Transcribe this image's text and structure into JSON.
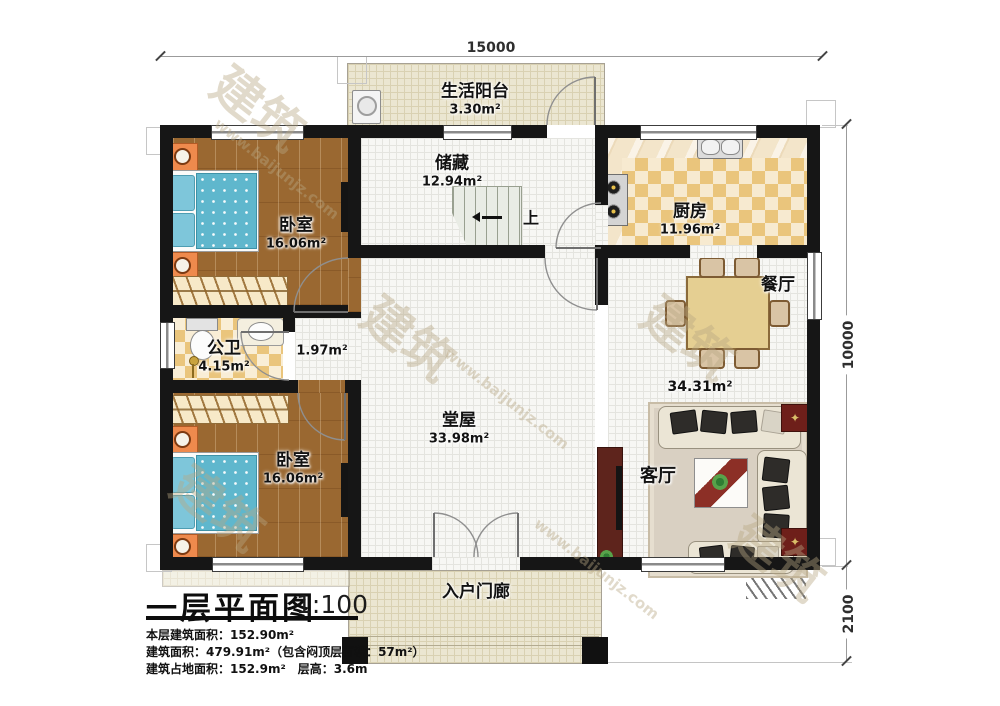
{
  "plan": {
    "dimensions": {
      "width_top": "15000",
      "height_right": "10000",
      "porch_depth": "2100"
    },
    "rooms": {
      "balcony": {
        "label": "生活阳台",
        "area": "3.30m²"
      },
      "storage": {
        "label": "储藏",
        "area": "12.94m²"
      },
      "kitchen": {
        "label": "厨房",
        "area": "11.96m²"
      },
      "bedroom_top": {
        "label": "卧室",
        "area": "16.06m²"
      },
      "bathroom": {
        "label": "公卫",
        "area": "4.15m²"
      },
      "hallway": {
        "area": "1.97m²"
      },
      "bedroom_bottom": {
        "label": "卧室",
        "area": "16.06m²"
      },
      "hall": {
        "label": "堂屋",
        "area": "33.98m²"
      },
      "dining": {
        "label": "餐厅"
      },
      "living": {
        "label": "客厅"
      },
      "living_dining_area": "34.31m²",
      "porch": {
        "label": "入户门廊"
      },
      "stairs": {
        "up_label": "上"
      }
    },
    "title_block": {
      "title": "一层平面图",
      "scale": "1:100",
      "stats": [
        "本层建筑面积：152.90m²",
        "建筑面积：479.91m²（包含闷顶层面积：57m²）",
        "建筑占地面积：152.9m²　层高：3.6m"
      ]
    },
    "watermark": {
      "text_cn": "建筑",
      "text_url": "www.baijunjz.com"
    },
    "icons": {
      "end_table_star": "✦"
    },
    "colors": {
      "wall": "#161616",
      "wood_floor": "#9a6831",
      "tile_accent": "#eac57c",
      "bed": "#5fb7cd",
      "grid_floor": "#f7f7f4",
      "outdoor_floor": "#ebe6d1",
      "tv_cabinet": "#5e241c"
    }
  }
}
